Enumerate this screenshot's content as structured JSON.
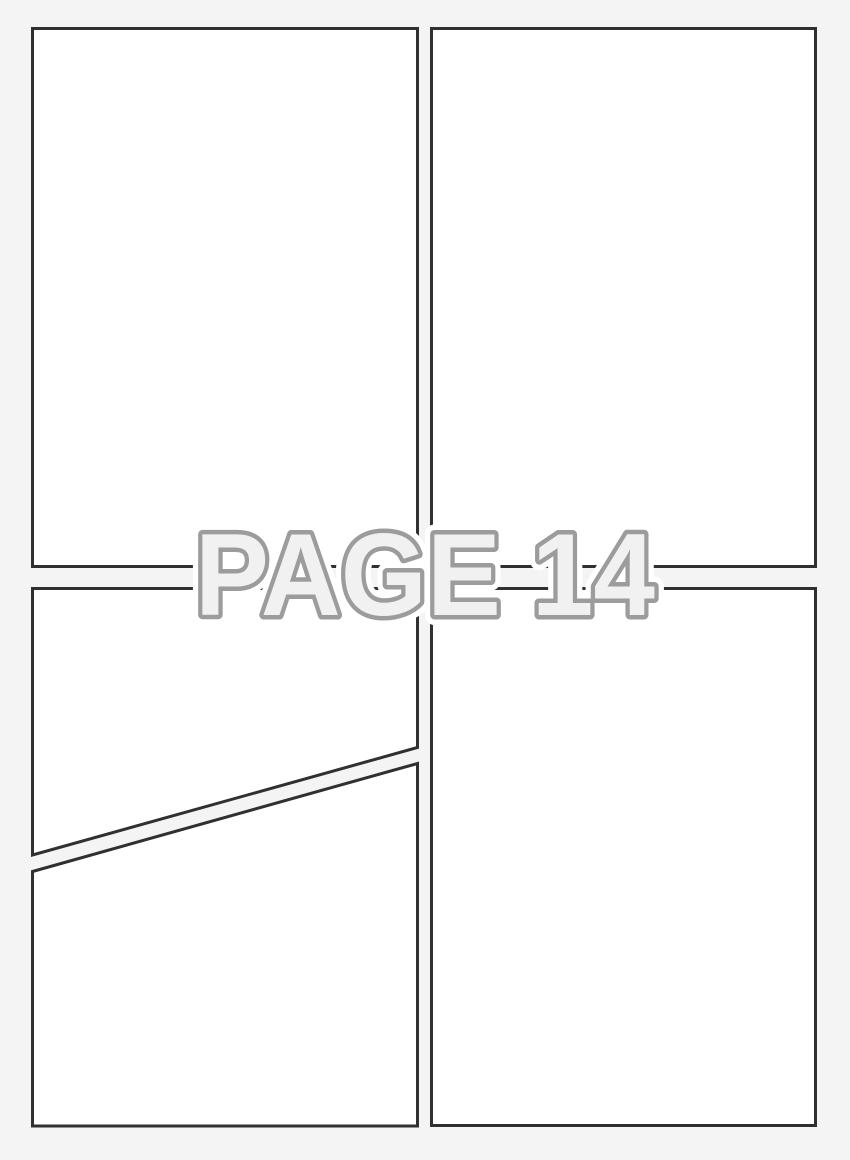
{
  "page": {
    "kind": "comic-page-template",
    "panel_count": 5
  },
  "watermark": {
    "label": "PAGE 14"
  },
  "panels": [
    {
      "id": "top-left",
      "shape": "rectangle"
    },
    {
      "id": "top-right",
      "shape": "rectangle"
    },
    {
      "id": "bottom-left-upper",
      "shape": "diagonal-cut"
    },
    {
      "id": "bottom-left-lower",
      "shape": "diagonal-cut"
    },
    {
      "id": "bottom-right",
      "shape": "rectangle"
    }
  ],
  "colors": {
    "page_bg": "#f4f4f4",
    "panel_fill": "#ffffff",
    "panel_border": "#303030",
    "watermark_fill": "#f1f1f1",
    "watermark_outline": "#9c9c9c",
    "watermark_halo": "#ffffff"
  }
}
